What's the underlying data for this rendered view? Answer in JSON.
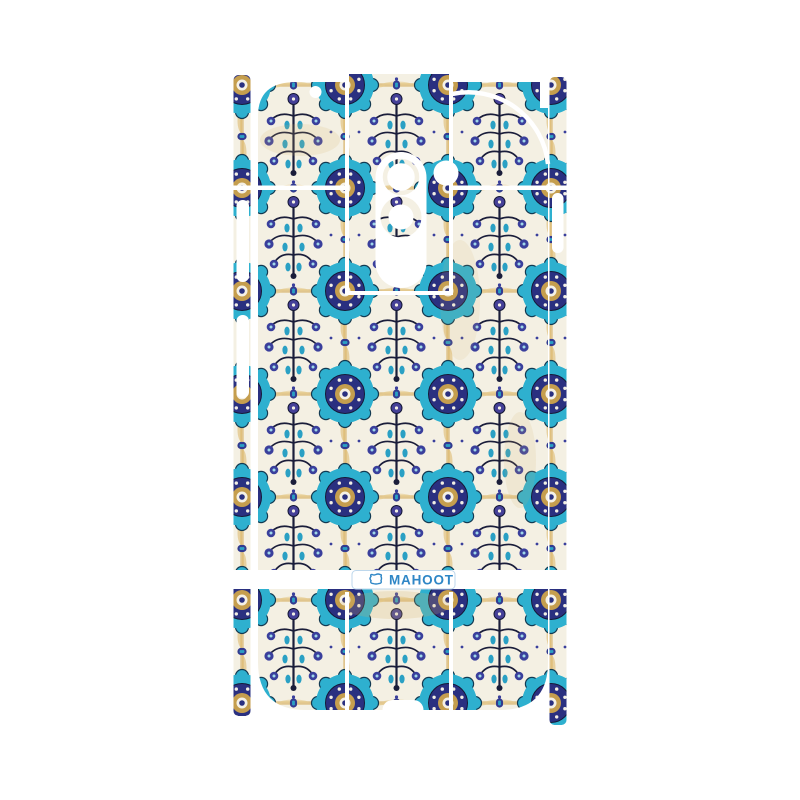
{
  "page": {
    "background": "#ffffff"
  },
  "product": {
    "kind": "full-body-phone-skin-sticker-sheet",
    "artwork": "blue-floral-mosaic-tile-pattern"
  },
  "brand": {
    "logo_text": "MAHOOT",
    "logo_color": "#2e86c6",
    "badge_background": "#ffffff",
    "badge_border": "#bdd7ec"
  },
  "palette": {
    "tile_ground": "#f4f0e3",
    "cobalt_blue": "#2a3080",
    "turquoise": "#2eb0cf",
    "teal": "#2aa0c4",
    "violet_blue": "#454098",
    "dark_outline": "#1a1d3a",
    "gold_stain": "#d8b269"
  }
}
